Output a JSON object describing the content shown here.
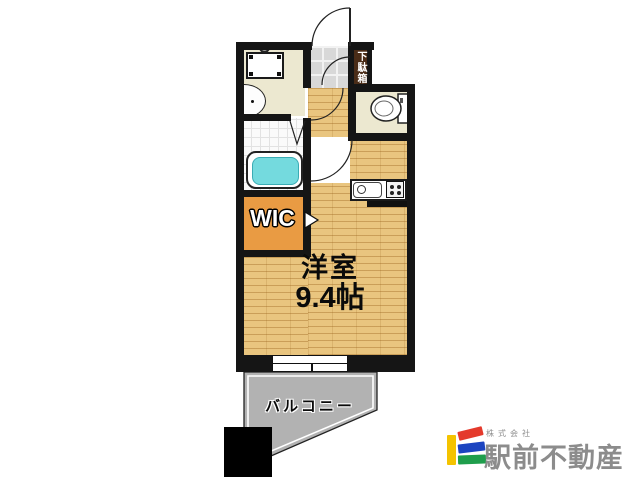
{
  "plan": {
    "room_label": "洋室",
    "room_size": "9.4帖",
    "wic_label": "WIC",
    "shoe_cabinet_label": "下駄箱",
    "balcony_label": "バルコニー",
    "colors": {
      "wall_black": "#151515",
      "wood_floor": "#e9c57f",
      "wic_orange": "#e99b43",
      "bathtub_cyan": "#74dade",
      "balcony_gray": "#b2b2b2",
      "service_room_cream": "#ece8d0",
      "shoe_cabinet_brown": "#4a2c17",
      "genkan_tile_gray": "#d8d8d8"
    }
  },
  "logo": {
    "company_prefix": "株式会社",
    "company_name": "駅前不動産",
    "text_color": "#8c8c8c",
    "mark_colors": {
      "yellow": "#f4c300",
      "red": "#e43a2c",
      "blue": "#1c44c0",
      "green": "#1f9e4c"
    }
  }
}
